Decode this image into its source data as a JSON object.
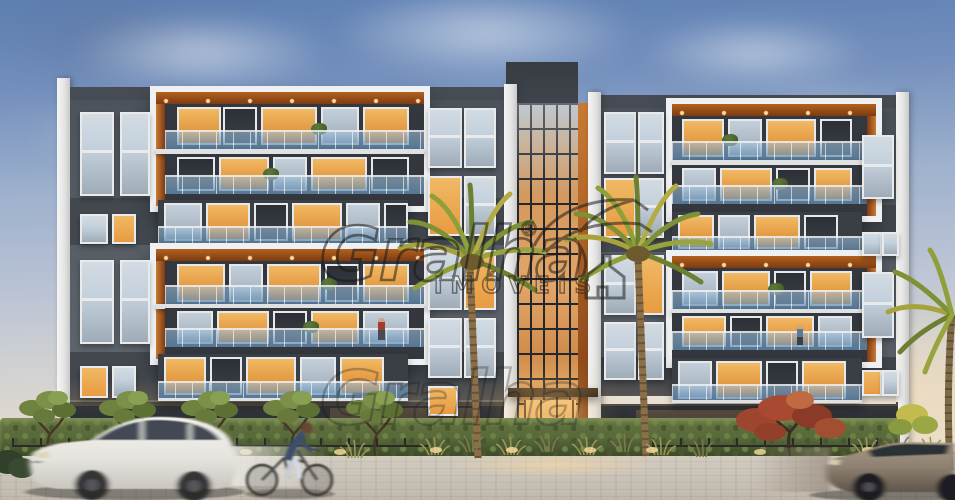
{
  "watermark": {
    "brand": "Gralha",
    "registered_mark": "®",
    "subtitle": "IMÓVEIS",
    "logo": "bird-over-house-outline"
  },
  "scene": {
    "type": "architectural-rendering",
    "time_of_day": "dusk",
    "description": "Street-level dusk rendering of a modern six-storey apartment block with a central glass atrium entrance, white-framed balcony volumes with wood soffits and glass railings, warm lit interiors, palm trees and hedges in front, a motion-blurred white SUV and cyclist on the left and a bronze sedan on the right.",
    "colors": {
      "sky_top": "#5d7fb3",
      "sky_mid": "#9db0cd",
      "sky_horizon": "#e7ddcb",
      "facade_dark": "#565c64",
      "facade_band": "#43484f",
      "roof_block": "#41464e",
      "trim_white": "#eef0f1",
      "wood_accent": "#b4611f",
      "wood_dark": "#7d3b12",
      "rail_glass": "#8fb4d4",
      "window_glass": "#c3d0dc",
      "window_lit": "#e89b42",
      "door_glow": "#f5c57c",
      "mullion": "#24272c",
      "hedge": "#57683a",
      "palm_olive": "#a8a23c",
      "palm_green": "#7e9136",
      "red_tree": "#a84a32",
      "pavement": "#cbc4b9",
      "suv_body": "#eceae5",
      "sedan_body": "#8d8071",
      "watermark_ink": "#161616"
    }
  }
}
